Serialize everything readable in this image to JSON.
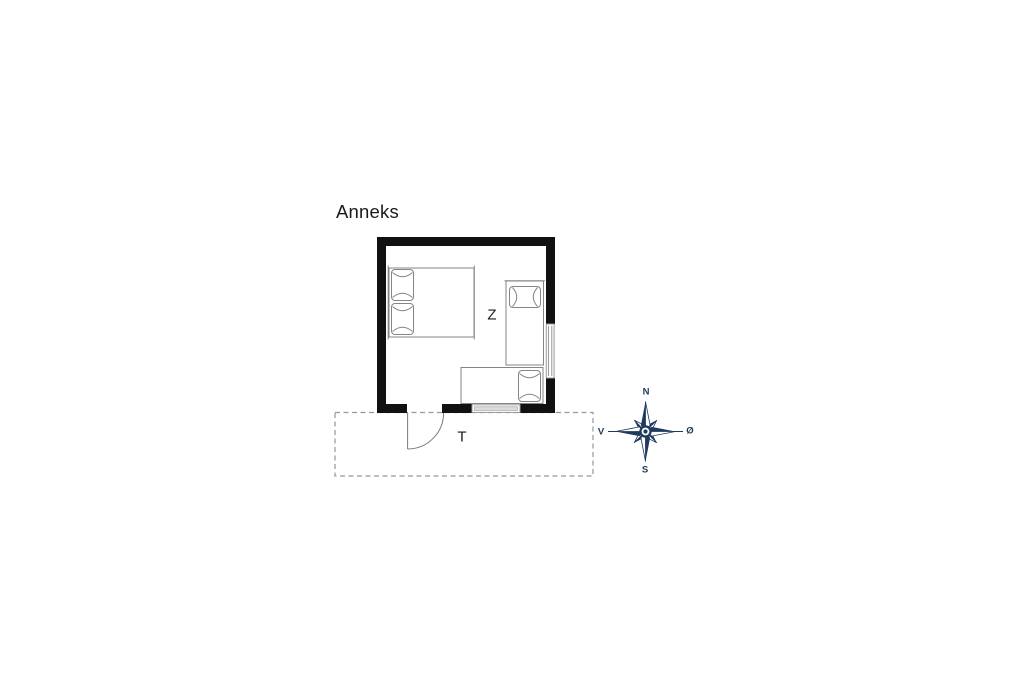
{
  "plan": {
    "title": "Anneks",
    "room_label": "Z",
    "terrace_label": "T"
  },
  "compass": {
    "north": "N",
    "south": "S",
    "west": "V",
    "east": "Ø"
  },
  "icons": {
    "compass": "compass-rose-icon",
    "door": "door-swing-icon",
    "double_bed": "double-bed-icon",
    "single_bed": "single-bed-icon",
    "bench_bed": "bench-bed-icon"
  },
  "colors": {
    "wall": "#111111",
    "furniture_line": "#858585",
    "dashed_line": "#979797",
    "text": "#1a1a1a",
    "compass_navy": "#1e3a5c"
  }
}
